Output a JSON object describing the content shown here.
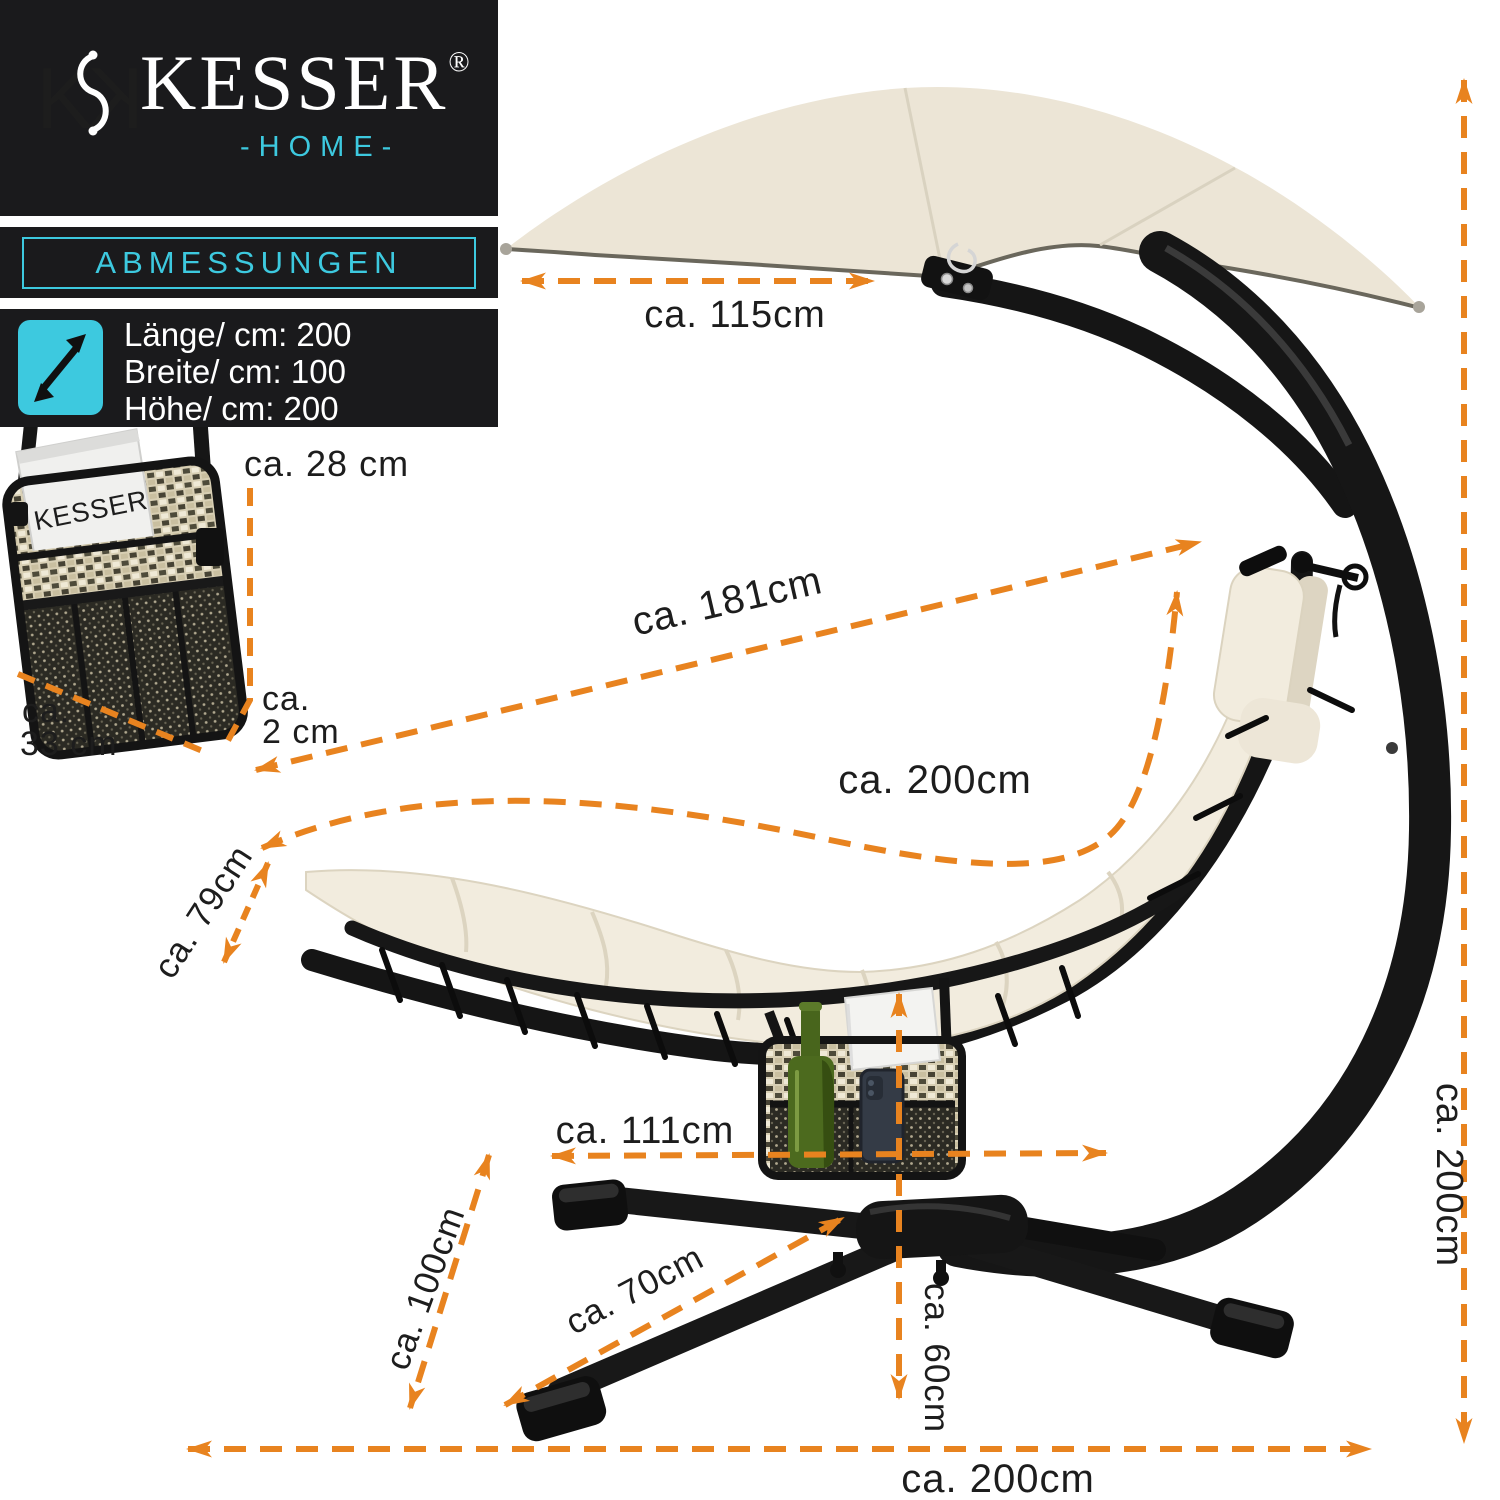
{
  "brand": {
    "wordmark": "KESSER",
    "registered": "®",
    "home": "-HOME-"
  },
  "section": {
    "title": "ABMESSUNGEN"
  },
  "specs": {
    "icon": "diagonal-resize-arrow-icon",
    "length": "Länge/ cm: 200",
    "width": "Breite/ cm: 100",
    "height": "Höhe/ cm: 200"
  },
  "magazine": {
    "brand": "KESSER"
  },
  "dimensions": {
    "canopy_width": "ca. 115cm",
    "pocket_height": "ca. 28 cm",
    "pocket_width_prefix": "ca.",
    "pocket_width": "33 cm",
    "pocket_depth_prefix": "ca.",
    "pocket_depth": "2 cm",
    "diagonal": "ca. 181cm",
    "lounger_length": "ca. 200cm",
    "lounger_width": "ca. 79cm",
    "base_depth": "ca. 111cm",
    "base_diagonal": "ca. 100cm",
    "leg_length": "ca. 70cm",
    "seat_height": "ca. 60cm",
    "total_height": "ca. 200cm",
    "total_length": "ca. 200cm"
  },
  "colors": {
    "accent_orange": "#E8831F",
    "accent_cyan": "#3DC9DF",
    "panel_black": "#1A1A1C",
    "canopy_cream": "#ECE5D6",
    "cushion_cream": "#F2ECDE"
  }
}
